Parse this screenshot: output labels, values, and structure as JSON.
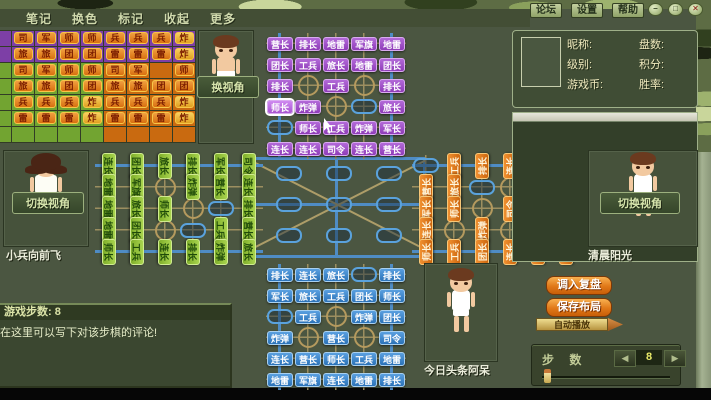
{
  "palette": {
    "purple": "#9b4fc0",
    "blue": "#3380c4",
    "green": "#8cc03c",
    "orange": "#e07818",
    "rail_blue": "#4f8cc4",
    "road_tan": "#9c8f60",
    "tile_orange": "#e6891e",
    "button_orange": "#e88820"
  },
  "menu": {
    "items": [
      "笔记",
      "换色",
      "标记",
      "收起",
      "更多"
    ]
  },
  "titlebar": {
    "buttons": [
      "论坛",
      "设置",
      "帮助"
    ],
    "window_controls": [
      "–",
      "□",
      "✕"
    ]
  },
  "info_panel": {
    "rows_left": [
      "昵称:",
      "级别:",
      "游戏币:"
    ],
    "rows_right": [
      "盘数:",
      "积分:",
      "胜率:"
    ]
  },
  "tracker": {
    "rows": [
      {
        "cells": [
          "司",
          "军",
          "师",
          "师",
          "兵",
          "兵",
          "兵",
          "炸"
        ]
      },
      {
        "cells": [
          "旅",
          "旅",
          "团",
          "团",
          "雷",
          "雷",
          "雷",
          "炸"
        ]
      },
      {
        "cells": [
          "司",
          "军",
          "师",
          "师",
          "司",
          "军",
          ".",
          "师"
        ]
      },
      {
        "cells": [
          "旅",
          "旅",
          "团",
          "团",
          "旅",
          "旅",
          "团",
          "团"
        ]
      },
      {
        "cells": [
          "兵",
          "兵",
          "兵",
          "炸",
          "兵",
          "兵",
          "兵",
          "炸"
        ]
      },
      {
        "cells": [
          "雷",
          "雷",
          "雷",
          "炸",
          "雷",
          "雷",
          "雷",
          "炸"
        ]
      },
      {
        "cells": [
          ".",
          ".",
          ".",
          ".",
          ".",
          ".",
          ".",
          "."
        ]
      }
    ]
  },
  "players": {
    "top": {
      "view_button": "换视角"
    },
    "left": {
      "name": "小兵向前飞",
      "view_button": "切换视角"
    },
    "right": {
      "name": "清晨阳光",
      "view_button": "切换视角"
    },
    "bottom": {
      "name": "今日头条阿呆"
    }
  },
  "board": {
    "top_arm": [
      [
        "营长",
        "排长",
        "地雷",
        "军旗",
        "地雷"
      ],
      [
        "团长",
        "工兵",
        "旅长",
        "地雷",
        "团长"
      ],
      [
        "排长",
        "@",
        "工兵",
        "@",
        "排长"
      ],
      [
        "师长*",
        "炸弹",
        "@",
        "#",
        "旅长"
      ],
      [
        "#",
        "师长",
        "工兵",
        "炸弹",
        "军长"
      ],
      [
        "连长",
        "连长",
        "司令",
        "连长",
        "营长"
      ]
    ],
    "bottom_arm": [
      [
        "排长",
        "连长",
        "旅长",
        "#",
        "排长"
      ],
      [
        "军长",
        "旅长",
        "工兵",
        "团长",
        "师长"
      ],
      [
        "#",
        "工兵",
        "@",
        "炸弹",
        "团长"
      ],
      [
        "炸弹",
        "@",
        "营长",
        "@",
        "司令"
      ],
      [
        "连长",
        "营长",
        "师长",
        "工兵",
        "地雷"
      ],
      [
        "地雷",
        "军旗",
        "连长",
        "地雷",
        "排长"
      ]
    ],
    "left_arm": [
      [
        "连长",
        "团长",
        "旅长",
        "排长",
        "军长",
        "司令"
      ],
      [
        "地雷",
        "军旗",
        "@",
        "炸弹",
        "营长",
        "连长"
      ],
      [
        "地雷",
        "旅长",
        "师长",
        "@",
        "#",
        "排长"
      ],
      [
        "地雷",
        "团长",
        "@",
        "#",
        "工兵",
        "营长"
      ],
      [
        "师长",
        "工兵",
        "连长",
        "排长",
        "炸弹",
        "旅长"
      ]
    ],
    "right_arm": [
      [
        "#",
        "工兵",
        "排长",
        "连长",
        "军旗",
        "地雷"
      ],
      [
        "营长",
        "旅长",
        "#",
        "@",
        "团长",
        "地雷"
      ],
      [
        "军长",
        "师长",
        "@",
        "司令",
        "旅长",
        "工兵"
      ],
      [
        "连长",
        "@",
        "炸弹",
        "@",
        "营长",
        "排长"
      ],
      [
        "师长",
        "工兵",
        "团长",
        "连长",
        "地雷",
        "炸弹"
      ]
    ],
    "center": [
      "#",
      "#",
      "#",
      "#",
      "#",
      "#",
      "#",
      "#",
      "#"
    ]
  },
  "replay_controls": {
    "load": "调入复盘",
    "save": "保存布局",
    "autoplay": "自动播放",
    "step_label": "步 数",
    "step_value": "8",
    "prev": "◀",
    "next": "▶"
  },
  "comment_panel": {
    "title": "游戏步数: 8",
    "body": "在这里可以写下对该步棋的评论!"
  }
}
